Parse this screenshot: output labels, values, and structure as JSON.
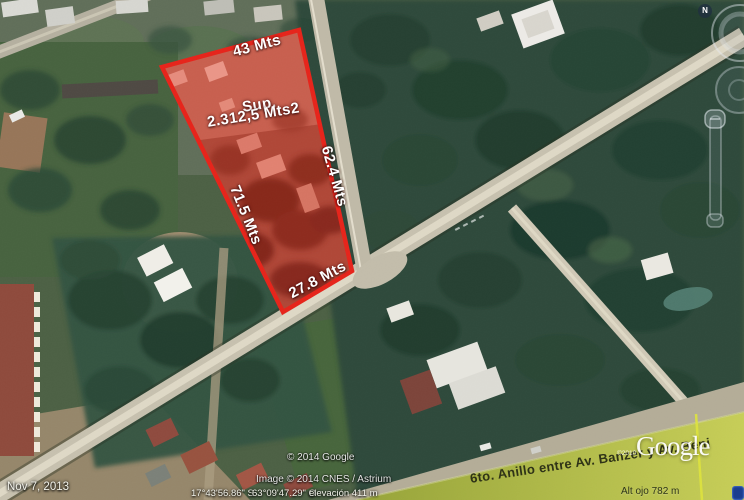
{
  "map_overlay": {
    "plot": {
      "top_length": "43 Mts",
      "area_label_line1": "Sup.",
      "area_label_line2": "2.312,5 Mts2",
      "left_length": "71.5 Mts",
      "right_length": "62.4 Mts",
      "bottom_length": "27.8 Mts"
    },
    "road_banner": "6to. Anillo entre Av. Banzer y Av. Beni"
  },
  "watermarks": {
    "google_logo": "Google",
    "logo_copyright": "©2010",
    "copyright": "© 2014 Google",
    "image_credit": "Image © 2014 CNES / Astrium"
  },
  "status_bar": {
    "date": "Nov  7, 2013",
    "latitude": "17°43'56.86\" S",
    "longitude": "63°09'47.29\" O",
    "elevation": "elevación  411 m",
    "eye_altitude": "Alt ojo   782 m"
  },
  "navigation": {
    "north_label": "N"
  },
  "colors": {
    "plot_outline": "#e6241b",
    "plot_fill": "rgba(224,38,24,0.36)",
    "band_green": "#c6cd57",
    "band_green_dark": "#96a339",
    "banner_text": "#2f3317",
    "label_white": "#ffffff"
  }
}
